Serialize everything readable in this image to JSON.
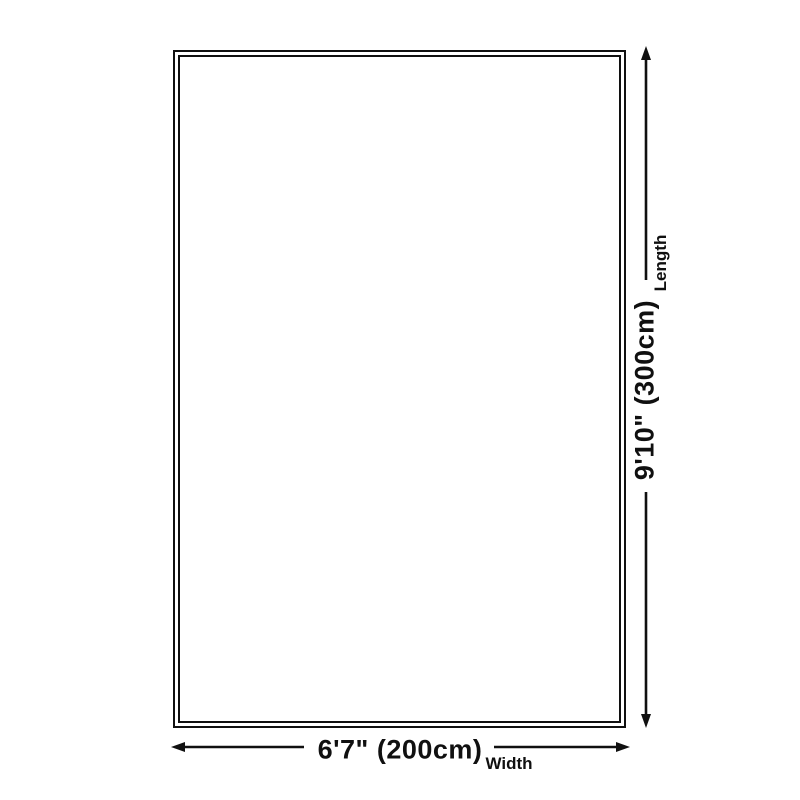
{
  "diagram": {
    "background_color": "#ffffff",
    "line_color": "#101010",
    "length_dimension": {
      "value": "9'10\" (300cm)",
      "label": "Length"
    },
    "width_dimension": {
      "value": "6'7\" (200cm)",
      "label": "Width"
    }
  }
}
